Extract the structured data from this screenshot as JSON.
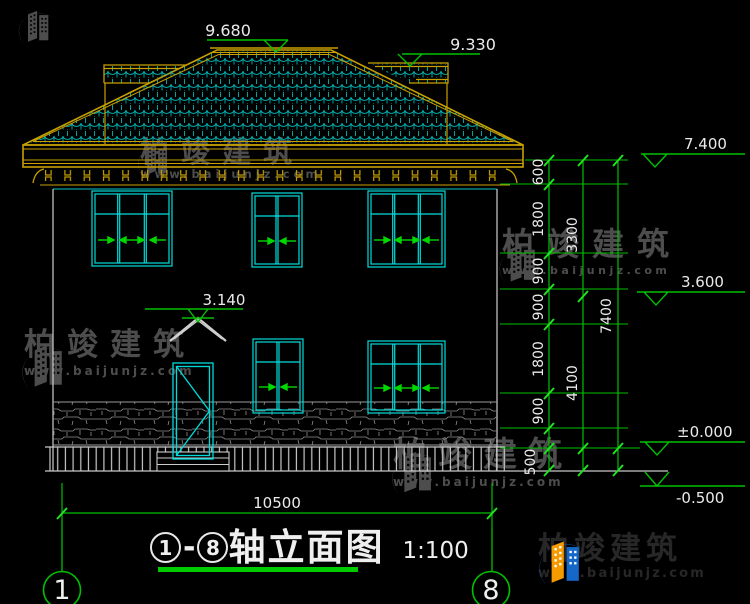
{
  "drawing": {
    "elevation_labels": {
      "main_ridge": "9.680",
      "side_ridge": "9.330",
      "eave": "7.400",
      "second_floor": "3.600",
      "ground": "±0.000",
      "footing": "-0.500",
      "canopy": "3.140"
    },
    "dimensions": {
      "chain_detail": [
        "600",
        "1800",
        "900",
        "900",
        "1800",
        "900",
        "500"
      ],
      "chain_mid": [
        "3300",
        "4100"
      ],
      "chain_total": "7400",
      "width_total": "10500"
    },
    "axis_bubbles": {
      "start": "1",
      "end": "8"
    }
  },
  "title_block": {
    "axis_start": "1",
    "axis_end": "8",
    "dash": "-",
    "name": "轴立面图",
    "scale": "1:100"
  },
  "watermark": {
    "brand": "柏竣建筑",
    "url": "www.baijunjz.com"
  },
  "footer_logo": {
    "brand": "柏竣建筑",
    "url": "www.baijunjz.com"
  },
  "colors": {
    "tile_cyan": "#00b4b4",
    "window_cyan": "#00dcdc",
    "trim_yellow": "#c8a000",
    "dim_green": "#00c000",
    "text_white": "#ebebeb",
    "wall_gray": "#cfcfcf",
    "watermark_gray": "#4d4d4d",
    "logo_blue": "#1668c8",
    "logo_orange": "#f59b00"
  }
}
